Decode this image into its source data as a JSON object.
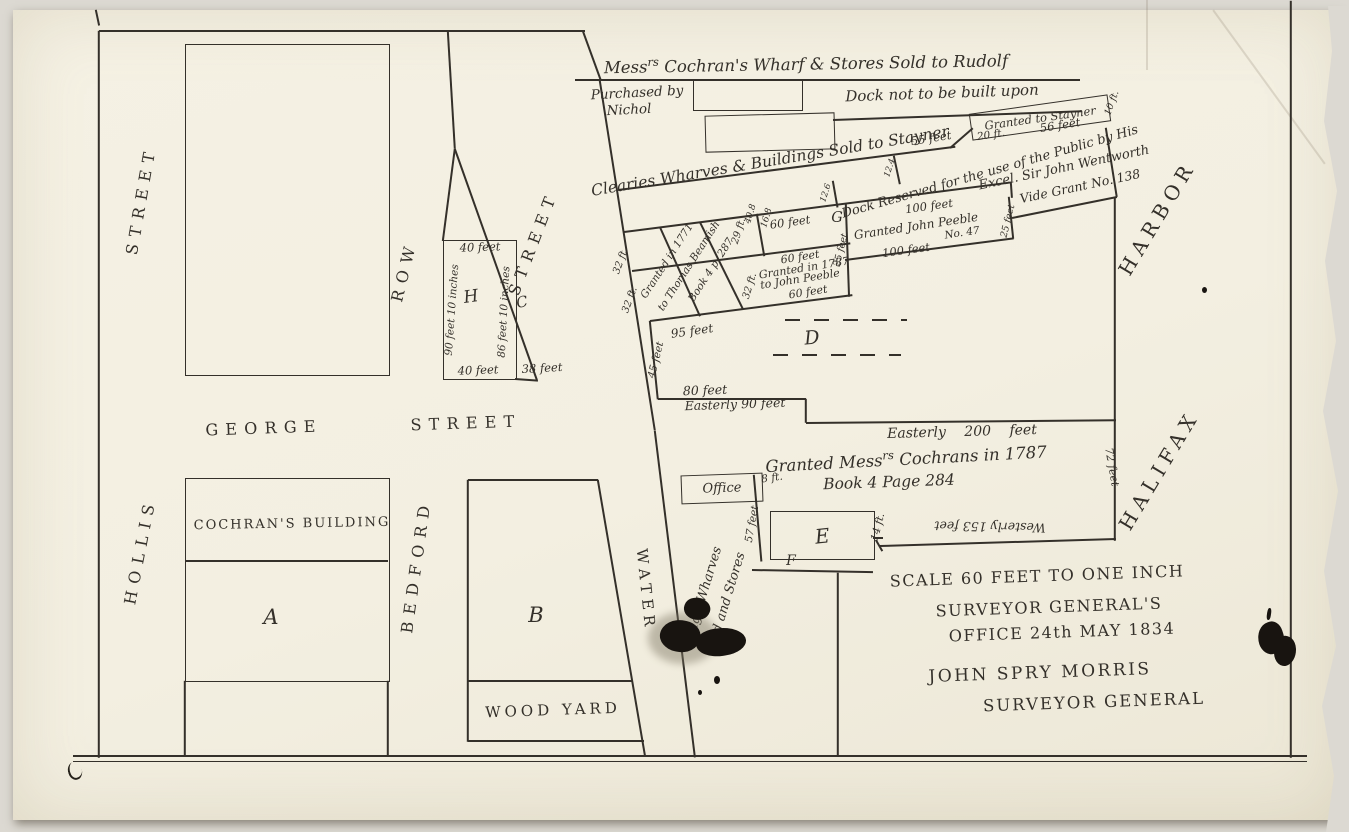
{
  "header": {
    "mess": "Mess",
    "mess_sup": "rs",
    "title_rest": " Cochran's Wharf & Stores Sold to Rudolf",
    "purchased_1": "Purchased by",
    "purchased_2": "Nichol",
    "dock_note": "Dock not to be built upon"
  },
  "wharf": {
    "clearies": "Clearies Wharves & Buildings Sold to Stayner",
    "stayner": "Granted to Stayner",
    "dock_reserved_1": "Dock Reserved for the use of the Public by His",
    "dock_reserved_2": "Excel. Sir John Wentworth",
    "dock_reserved_3": "Vide Grant No. 138"
  },
  "grants": {
    "beamish_1": "Granted in 1771",
    "beamish_2": "to Thomas Beamish",
    "beamish_3": "Book 4 p. 287",
    "peeble87_1": "Granted in 1787",
    "peeble87_2": "to John Peeble",
    "peeble47_1": "Granted John Peeble",
    "peeble47_2": "No. 47",
    "cochrans_1a": "Granted Mess",
    "cochrans_1b": "rs",
    "cochrans_1c": " Cochrans in 1787",
    "cochrans_2": "Book 4 Page 284"
  },
  "streets": {
    "hollis": "HOLLIS",
    "hollis_street": "STREET",
    "george": "GEORGE",
    "george_street": "STREET",
    "bedford": "BEDFORD",
    "row": "ROW",
    "upper_street": "STREET",
    "water": "WATER"
  },
  "harbor": {
    "halifax": "HALIFAX",
    "harbor": "HARBOR"
  },
  "parcels": {
    "a": "A",
    "b": "B",
    "c": "C",
    "d": "D",
    "e": "E",
    "f": "F",
    "g": "G",
    "h": "H",
    "cochrans_building": "COCHRAN'S BUILDING",
    "wood_yard": "WOOD YARD",
    "office": "Office",
    "kings_1": "King's Wharves",
    "kings_2": "Yard and Stores"
  },
  "measurements": {
    "forty_top": "40 feet",
    "ninety_ten": "90 feet 10 inches",
    "eightysix_ten": "86 feet 10 inches",
    "forty_bottom": "40 feet",
    "thirtyeight": "38 feet",
    "ninetyfive": "95 feet",
    "thirtytwo_a": "32 ft.",
    "thirtytwo_b": "32 ft.",
    "thirtytwo_c": "32 ft.",
    "twentynine": "29 ft.",
    "forty_eight": "40.8",
    "sixteen_eight": "16.8",
    "sixty_a": "60 feet",
    "sixty_b": "60 feet",
    "sixty_c": "60 feet",
    "hundred_a": "100 feet",
    "hundred_b": "100 feet",
    "twentyfive_a": "25 feet",
    "twentyfive_b": "25 feet",
    "fiftyfive": "55 feet",
    "twelve_four": "12.4",
    "twelve_six": "12.6",
    "twenty": "20 ft.",
    "fiftysix": "56 feet",
    "ten": "10 ft.",
    "fortyfive": "45 feet",
    "eighty": "80 feet",
    "easterly_90": "Easterly 90 feet",
    "easterly_200": "Easterly 200 feet",
    "seventytwo": "72 feet",
    "westerly_153": "Westerly 153 feet",
    "eight": "8 ft.",
    "fiftyseven": "57 feet",
    "fourteen": "14 ft."
  },
  "footer": {
    "scale": "SCALE 60 FEET TO ONE INCH",
    "sg_1": "SURVEYOR GENERAL'S",
    "sg_2": "OFFICE  24th MAY 1834",
    "sign": "JOHN SPRY MORRIS",
    "sign_title": "SURVEYOR GENERAL"
  },
  "colors": {
    "paper": "#f3efe1",
    "ink": "#34302a",
    "scan_bg": "#dcd9d2"
  }
}
